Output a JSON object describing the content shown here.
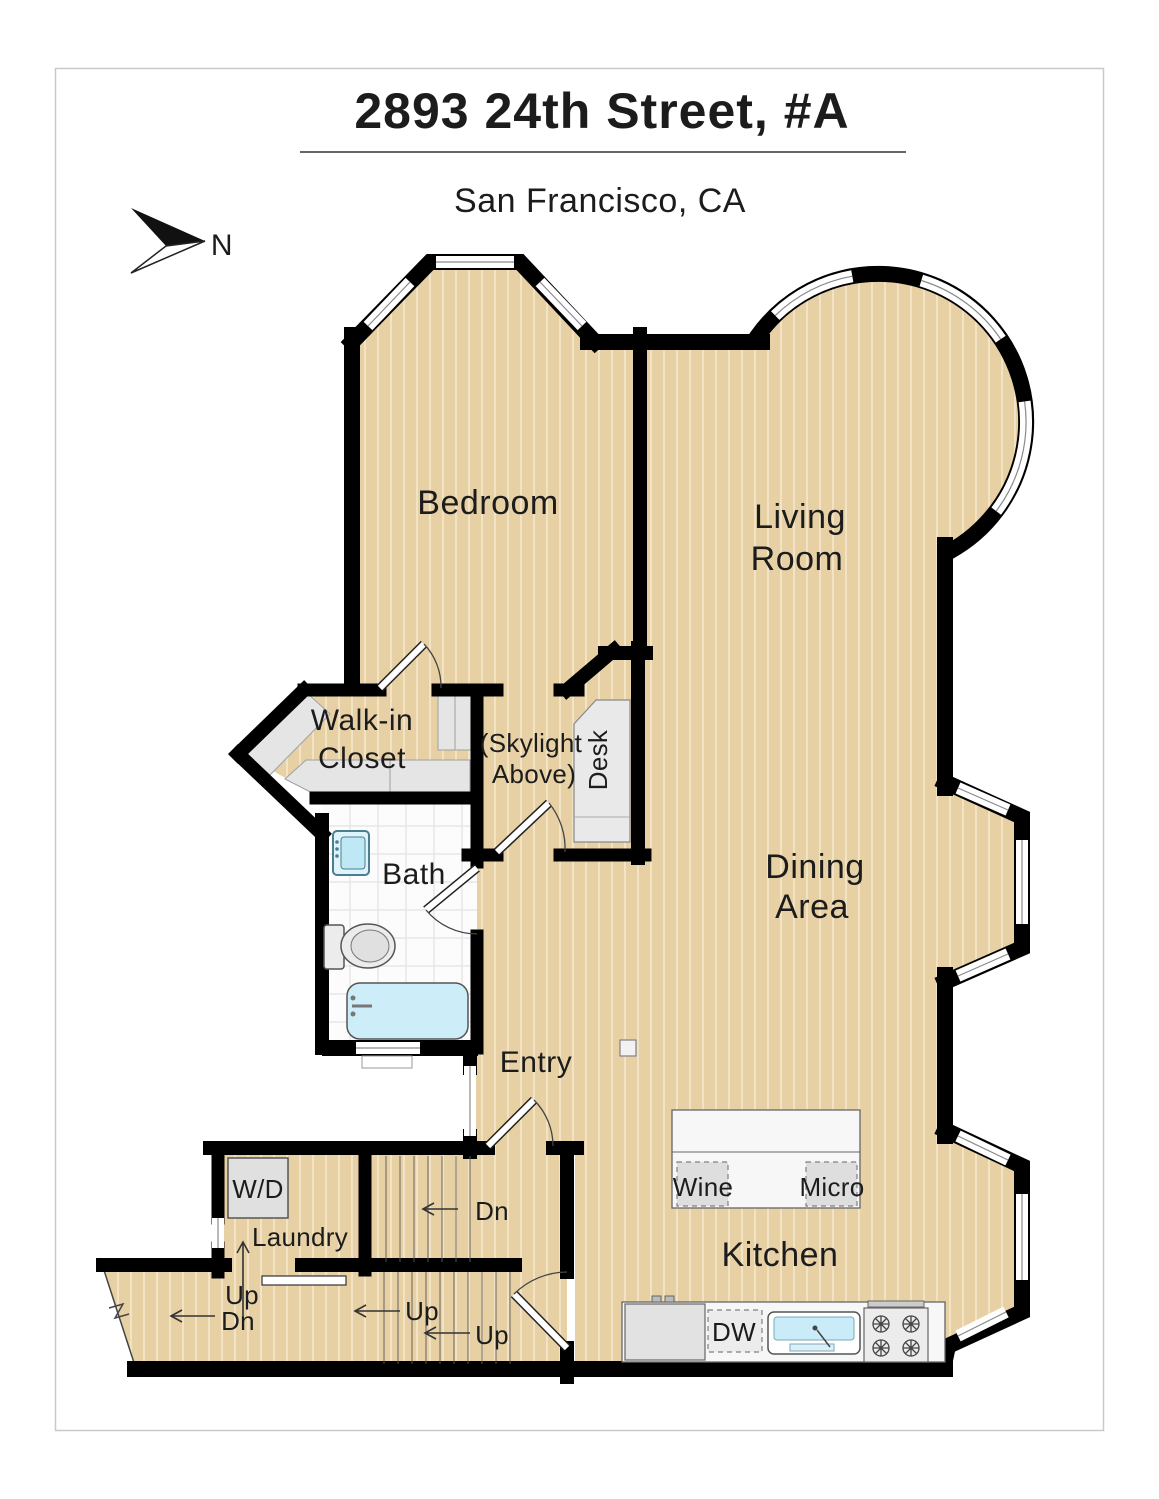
{
  "header": {
    "title": "2893 24th Street, #A",
    "subtitle": "San Francisco, CA"
  },
  "compass": {
    "north_label": "N"
  },
  "rooms": {
    "bedroom": "Bedroom",
    "living1": "Living",
    "living2": "Room",
    "dining1": "Dining",
    "dining2": "Area",
    "closet1": "Walk-in",
    "closet2": "Closet",
    "skylight1": "(Skylight",
    "skylight2": "Above)",
    "desk": "Desk",
    "bath": "Bath",
    "entry": "Entry",
    "kitchen": "Kitchen",
    "laundry": "Laundry"
  },
  "appliances": {
    "washer_dryer": "W/D",
    "wine": "Wine",
    "micro": "Micro",
    "dishwasher": "DW"
  },
  "stairs": {
    "dn_upper": "Dn",
    "up_mid": "Up",
    "up_right": "Up",
    "up_left": "Up",
    "dn_left": "Dn"
  },
  "colors": {
    "floor_tan": "#e7d0a4",
    "floor_stripe": "#f2e3c4",
    "wall_black": "#000000",
    "bath_tile": "#fcfcfc",
    "fixture_blue": "#c9ecf8",
    "shelf_gray": "#e5e5e5",
    "page_border": "#c9c9c9",
    "text": "#1c1c1c"
  }
}
